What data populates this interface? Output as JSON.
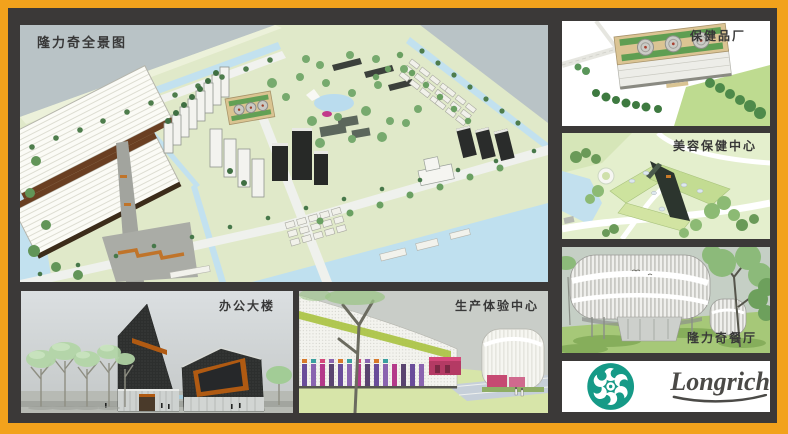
{
  "panels": {
    "overview": {
      "label": "隆力奇全景图"
    },
    "factory": {
      "label": "保健品厂"
    },
    "beauty": {
      "label": "美容保健中心"
    },
    "restaurant": {
      "label": "隆力奇餐厅"
    },
    "office": {
      "label": "办公大楼"
    },
    "production": {
      "label": "生产体验中心"
    }
  },
  "logo": {
    "brand": "Longrich",
    "icon": "longrich-flower-icon"
  },
  "theme": {
    "border-orange": "#F2A21C",
    "gap-dark": "#3B3938",
    "label-dark": "#383838",
    "logo-green": "#169A87",
    "logo-text": "#4B4A47"
  }
}
